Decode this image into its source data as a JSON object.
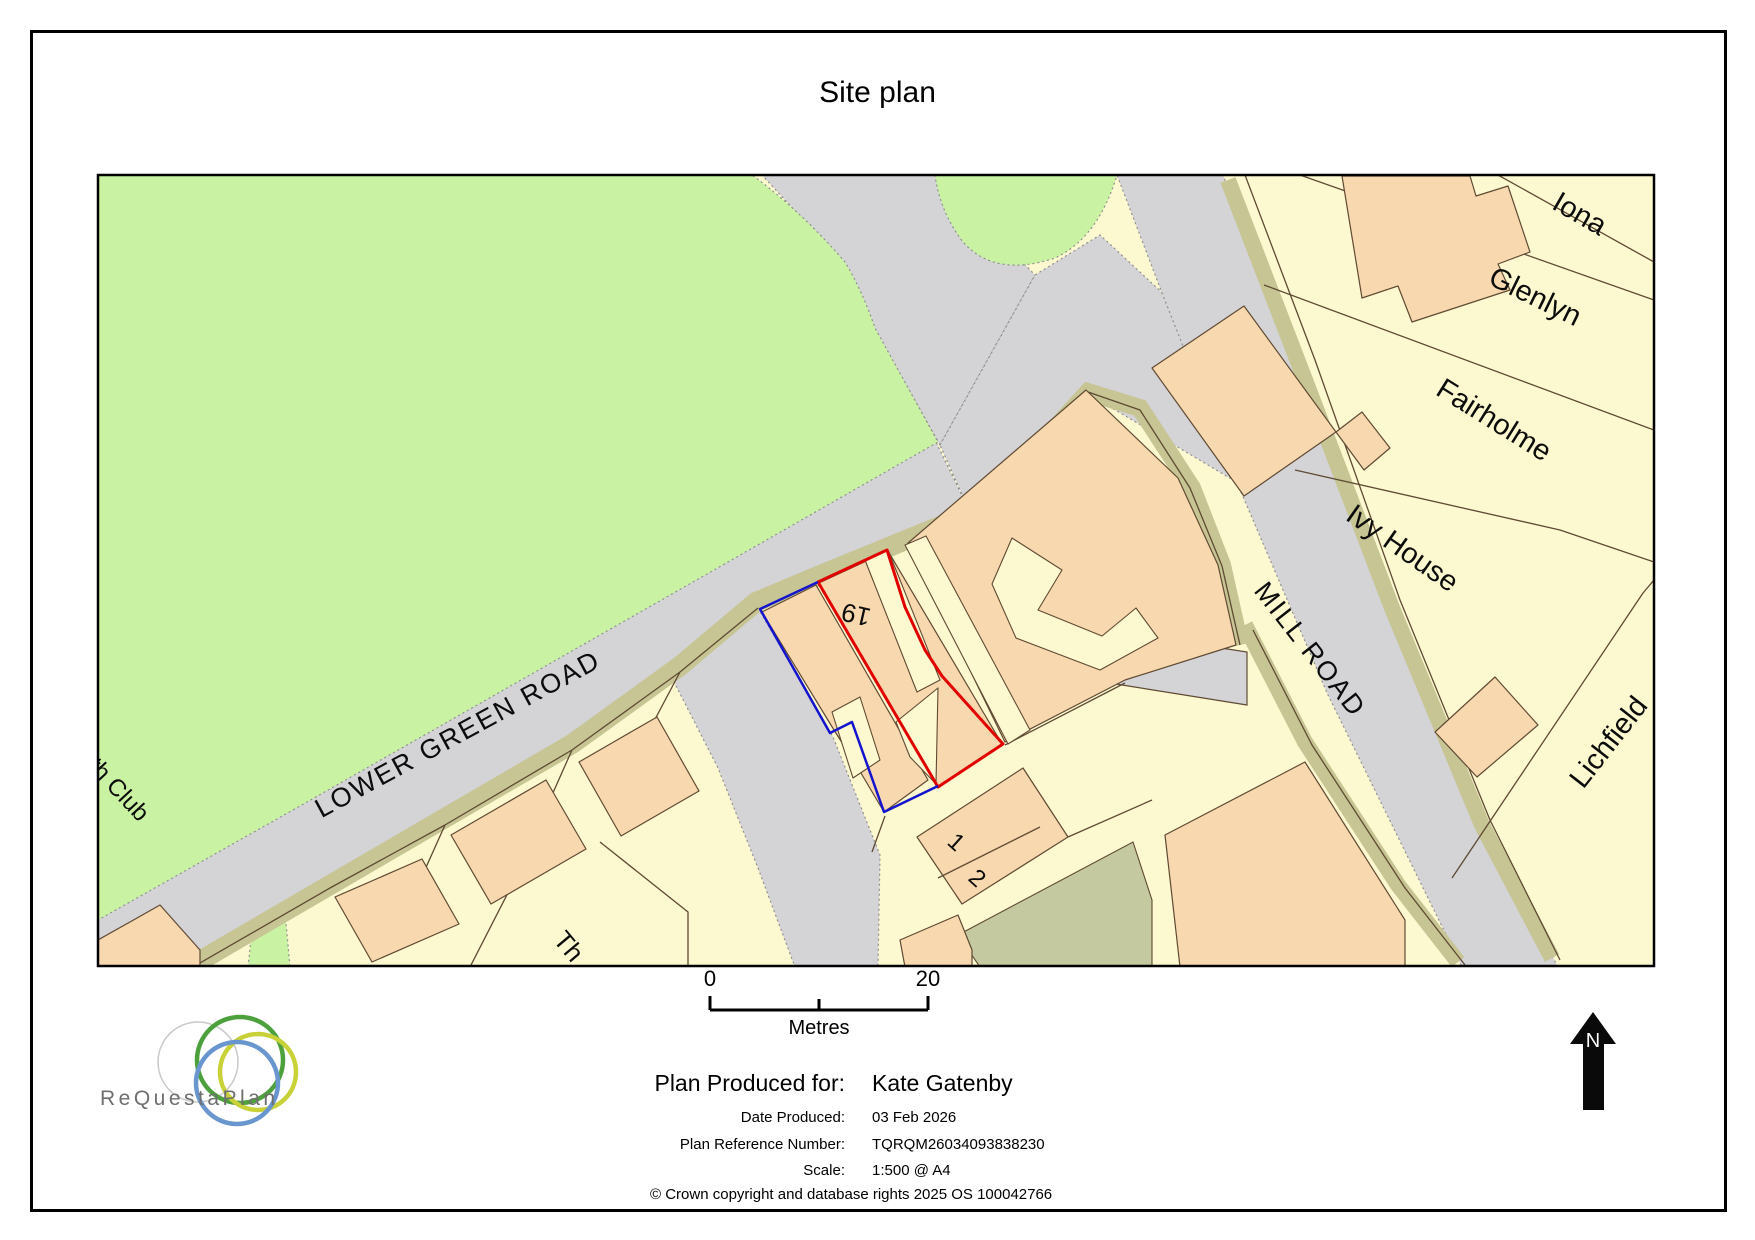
{
  "title": "Site plan",
  "map": {
    "roads": [
      {
        "name": "LOWER GREEN ROAD"
      },
      {
        "name": "MILL ROAD"
      }
    ],
    "properties": [
      {
        "name": "Iona"
      },
      {
        "name": "Glenlyn"
      },
      {
        "name": "Fairholme"
      },
      {
        "name": "Ivy House"
      },
      {
        "name": "Lichfield"
      },
      {
        "name": "th Club"
      },
      {
        "name": "Th"
      }
    ],
    "plots": [
      {
        "number": "19",
        "outline_color": "#e10000"
      },
      {
        "number": "1"
      },
      {
        "number": "2"
      }
    ],
    "colors": {
      "parcel_cream": "#fcf8d0",
      "building_peach": "#f8d8ae",
      "open_green": "#c9f3a3",
      "road_grey": "#d4d3d6",
      "verge_olive": "#c6c593",
      "highlight_red": "#e10000",
      "highlight_blue": "#1414ce"
    }
  },
  "scale_bar": {
    "start": "0",
    "end": "20",
    "unit": "Metres"
  },
  "compass": {
    "label": "N"
  },
  "logo": {
    "brand": "ReQuestaPlan"
  },
  "details": {
    "produced_for_label": "Plan Produced for:",
    "produced_for": "Kate Gatenby",
    "date_label": "Date Produced:",
    "date": "03 Feb 2026",
    "ref_label": "Plan Reference Number:",
    "ref": "TQRQM26034093838230",
    "scale_label": "Scale:",
    "scale": "1:500 @ A4"
  },
  "copyright": "© Crown copyright and database rights 2025 OS 100042766"
}
